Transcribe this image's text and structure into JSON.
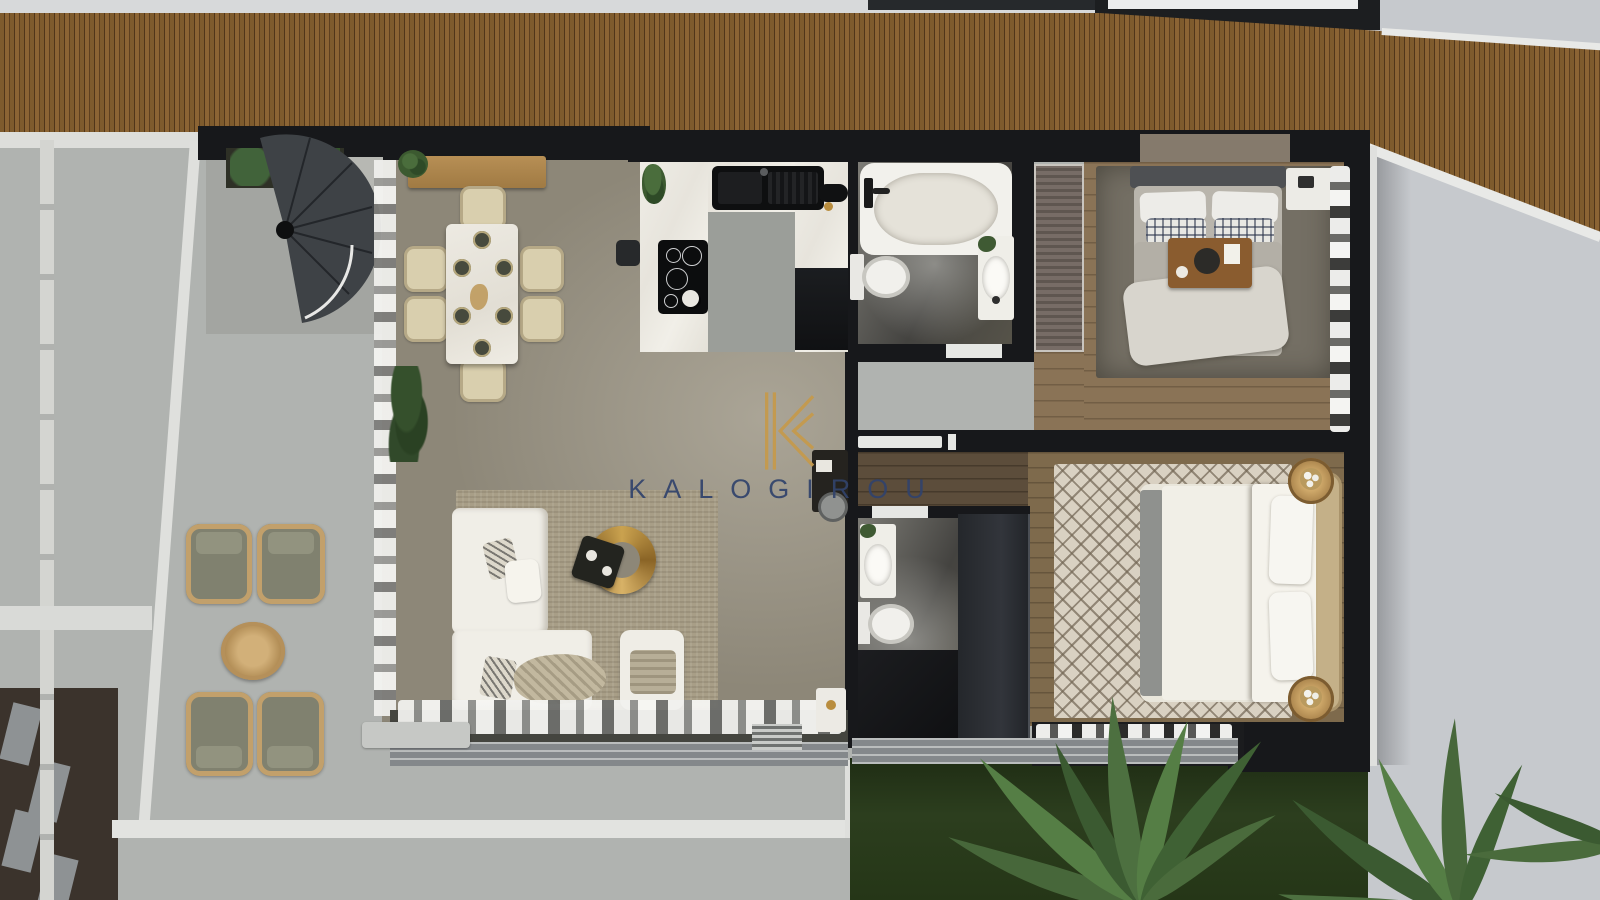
{
  "watermark": {
    "logo_letter": "K",
    "brand_name": "KALOGIROU",
    "logo_color": "#c59a4d",
    "text_color": "#31436c"
  },
  "palette": {
    "deck_wood": "#7e5b2d",
    "terrace_concrete": "#b0b3b0",
    "neighbor_terrace": "#c6c9cd",
    "living_floor": "#8d8778",
    "bedroom_wood": "#8a7356",
    "bathroom_marble": "#454440",
    "counter_marble": "#ebe9e2",
    "wall": "#17181b",
    "grass": "#293a1c",
    "gold_accent": "#b98d3e"
  },
  "scene": {
    "type": "top-down 3D floor plan render of an apartment",
    "rooms": [
      {
        "name": "living-dining-room",
        "contents": [
          "l-shaped white sofa",
          "round gold coffee table",
          "ottoman with blanket",
          "beige area rug",
          "dining table with six chairs and six place settings",
          "wooden sideboard",
          "floor plant",
          "desk nook"
        ]
      },
      {
        "name": "kitchen",
        "contents": [
          "u-shaped marble counter",
          "black double sink",
          "induction cooktop",
          "black appliance block",
          "counter plant"
        ]
      },
      {
        "name": "bathroom-1",
        "contents": [
          "bathtub",
          "toilet",
          "vanity with oval sink"
        ]
      },
      {
        "name": "bedroom-1",
        "contents": [
          "double bed with plaid pillows",
          "breakfast tray",
          "white nightstand",
          "louvered closet",
          "gray rug",
          "window curtains"
        ]
      },
      {
        "name": "bathroom-2",
        "contents": [
          "vanity sink",
          "toilet",
          "dark shower"
        ]
      },
      {
        "name": "bedroom-2",
        "contents": [
          "double bed with headboard on right",
          "two round rattan nightstands with flowers",
          "trellis pattern rug",
          "dark wardrobe",
          "window curtains"
        ]
      },
      {
        "name": "terrace",
        "contents": [
          "four wicker lounge chairs",
          "round rattan coffee table",
          "spiral staircase",
          "planter box",
          "stepping stone path",
          "white curbs and railings"
        ]
      },
      {
        "name": "garden",
        "contents": [
          "lawn",
          "palm tree fronds"
        ]
      }
    ]
  }
}
